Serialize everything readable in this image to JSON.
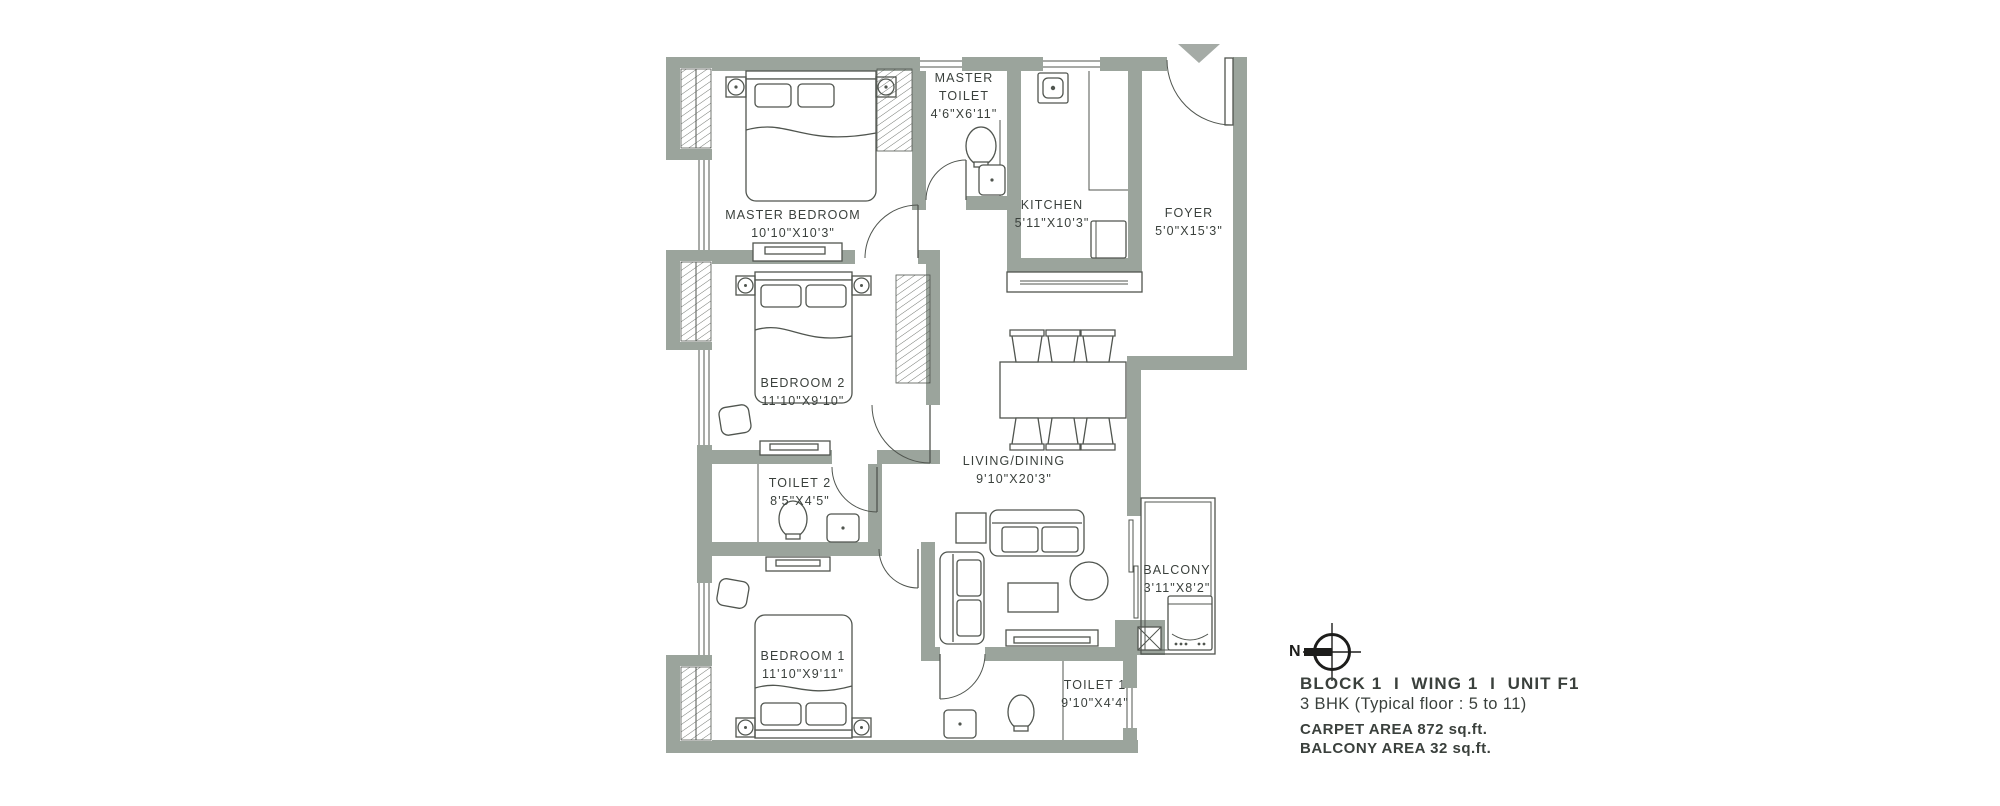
{
  "colors": {
    "wall": "#9ba49c",
    "line": "#50554f",
    "text": "#3a403c",
    "tri": "#a5aba6",
    "ink": "#1d1d1b"
  },
  "rooms": {
    "master_bedroom": {
      "name": "MASTER BEDROOM",
      "dims": "10'10\"X10'3\""
    },
    "master_toilet": {
      "name": "MASTER TOILET",
      "dims": "4'6\"X6'11\""
    },
    "kitchen": {
      "name": "KITCHEN",
      "dims": "5'11\"X10'3\""
    },
    "foyer": {
      "name": "FOYER",
      "dims": "5'0\"X15'3\""
    },
    "bedroom2": {
      "name": "BEDROOM 2",
      "dims": "11'10\"X9'10\""
    },
    "toilet2": {
      "name": "TOILET 2",
      "dims": "8'5\"X4'5\""
    },
    "living_dining": {
      "name": "LIVING/DINING",
      "dims": "9'10\"X20'3\""
    },
    "balcony": {
      "name": "BALCONY",
      "dims": "3'11\"X8'2\""
    },
    "bedroom1": {
      "name": "BEDROOM 1",
      "dims": "11'10\"X9'11\""
    },
    "toilet1": {
      "name": "TOILET 1",
      "dims": "9'10\"X4'4\""
    }
  },
  "info": {
    "north": "N",
    "block": "BLOCK 1  I  WING 1  I  UNIT F1",
    "type": "3 BHK (Typical floor : 5 to 11)",
    "carpet": "CARPET AREA 872 sq.ft.",
    "balcony_area": "BALCONY AREA 32 sq.ft."
  }
}
